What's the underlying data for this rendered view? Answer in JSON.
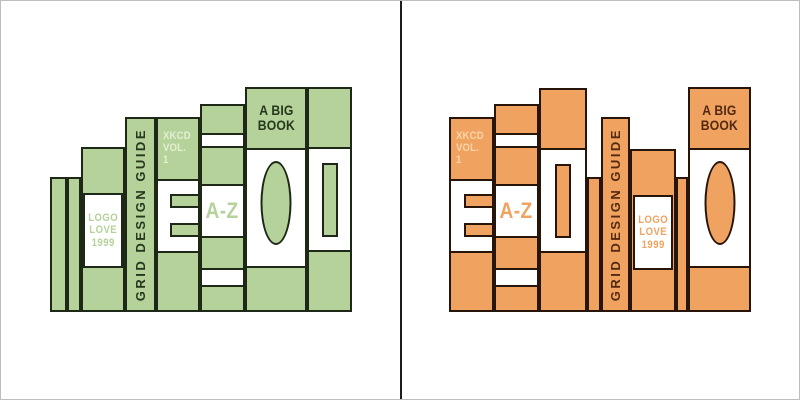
{
  "canvas": {
    "width": 800,
    "height": 400,
    "background": "#ffffff",
    "frame_color": "#bdbdbd",
    "divider_color": "#1d1d1d",
    "shelf_bottom": 311
  },
  "panels": [
    {
      "name": "left",
      "description": "books sorted by ascending height",
      "colors": {
        "accent": "#b5d29a",
        "stroke": "#1d2817",
        "dark_text": "#26371d",
        "pale_text": "#e4eed2"
      },
      "books": [
        {
          "ref": "thin",
          "x": 49,
          "w": 17,
          "top": 176
        },
        {
          "ref": "thin",
          "x": 66,
          "w": 14,
          "top": 176
        },
        {
          "ref": "logo-love",
          "x": 80,
          "w": 44,
          "top": 146
        },
        {
          "ref": "grid-guide",
          "x": 124,
          "w": 31,
          "top": 116
        },
        {
          "ref": "xkcd",
          "x": 155,
          "w": 44,
          "top": 116
        },
        {
          "ref": "a-z",
          "x": 199,
          "w": 45,
          "top": 103
        },
        {
          "ref": "a-big-book",
          "x": 244,
          "w": 62,
          "top": 86
        },
        {
          "ref": "window",
          "x": 306,
          "w": 45,
          "top": 86
        }
      ]
    },
    {
      "name": "right",
      "description": "same books in mixed order",
      "colors": {
        "accent": "#f0a360",
        "stroke": "#27150a",
        "dark_text": "#55290f",
        "pale_text": "#f9d5a8"
      },
      "books": [
        {
          "ref": "xkcd",
          "x": 448,
          "w": 45,
          "top": 116
        },
        {
          "ref": "a-z",
          "x": 493,
          "w": 45,
          "top": 103
        },
        {
          "ref": "window",
          "x": 538,
          "w": 48,
          "top": 87
        },
        {
          "ref": "thin",
          "x": 586,
          "w": 14,
          "top": 176
        },
        {
          "ref": "grid-guide",
          "x": 600,
          "w": 29,
          "top": 116
        },
        {
          "ref": "logo-love",
          "x": 629,
          "w": 46,
          "top": 148
        },
        {
          "ref": "thin",
          "x": 675,
          "w": 12,
          "top": 176
        },
        {
          "ref": "a-big-book",
          "x": 687,
          "w": 63,
          "top": 86
        }
      ]
    }
  ],
  "book_library": {
    "thin": {
      "parts": []
    },
    "logo-love": {
      "parts": [
        {
          "name": "logo-love-label",
          "type": "inset_label",
          "center": true,
          "w": 40,
          "y": 44,
          "h": 75,
          "text": "LOGO\nLOVE\n1999",
          "color": "accent",
          "size": 11,
          "lh": 12.5,
          "ls": 0.5
        }
      ]
    },
    "grid-guide": {
      "parts": [
        {
          "name": "grid-guide-spine-title",
          "type": "vtext",
          "text": "GRID DESIGN GUIDE",
          "color": "dark",
          "size": 13,
          "ls": 2.5
        }
      ]
    },
    "xkcd": {
      "parts": [
        {
          "name": "xkcd-spine-title",
          "type": "text",
          "align": "left",
          "x": 5,
          "y": 11,
          "text": "XKCD\nVOL. 1",
          "color": "pale",
          "size": 11,
          "lh": 12,
          "ls": 0.2
        },
        {
          "name": "e-label",
          "type": "band",
          "y": 60,
          "h": 74
        },
        {
          "name": "e-notch-top",
          "type": "rect",
          "flush": "right",
          "w": 28,
          "y": 75,
          "h": 14
        },
        {
          "name": "e-notch-bottom",
          "type": "rect",
          "flush": "right",
          "w": 28,
          "y": 104,
          "h": 14
        }
      ]
    },
    "a-z": {
      "parts": [
        {
          "name": "az-top-band",
          "type": "band",
          "y": 27,
          "h": 15
        },
        {
          "name": "az-label",
          "type": "band",
          "y": 78,
          "h": 54,
          "text": "A-Z",
          "color": "accent",
          "size": 22,
          "lh": 22,
          "ls": 0.5
        },
        {
          "name": "az-bottom-band",
          "type": "band",
          "y": 162,
          "h": 19
        }
      ]
    },
    "a-big-book": {
      "parts": [
        {
          "name": "big-book-title",
          "type": "text",
          "y": 14,
          "text": "A BIG\nBOOK",
          "color": "dark",
          "size": 14,
          "lh": 15,
          "ls": 0.2
        },
        {
          "name": "big-book-label",
          "type": "band",
          "y": 59,
          "h": 120
        },
        {
          "name": "big-book-ellipse",
          "type": "ellipse",
          "center": true,
          "w": 31,
          "y": 72,
          "h": 84
        }
      ]
    },
    "window": {
      "parts": [
        {
          "name": "window-label",
          "type": "band",
          "y": 58,
          "h": 105
        },
        {
          "name": "window-rect",
          "type": "rect",
          "center": true,
          "w": 16,
          "y": 74,
          "h": 74
        }
      ]
    }
  }
}
